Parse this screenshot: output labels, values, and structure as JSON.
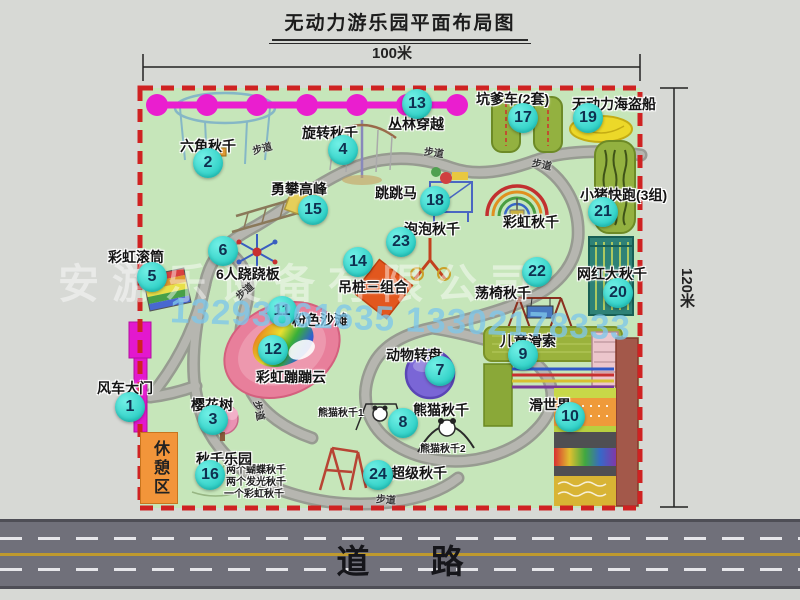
{
  "title": "无动力游乐园平面布局图",
  "dimensions": {
    "width_label": "100米",
    "height_label": "120米"
  },
  "road": {
    "label": "道 路"
  },
  "watermark": {
    "company": "安游乐设备有限公司",
    "phone": "13293861635 13302178333"
  },
  "rest_area_label": "休憩区",
  "trail_label": "步道",
  "rainbow_swing_label": "彩虹秋千",
  "panda_sub1": "熊猫秋千1",
  "panda_sub2": "熊猫秋千2",
  "swing_park_notes": [
    "两个蝴蝶秋千",
    "两个发光秋千",
    "一个彩虹秋千"
  ],
  "markers": [
    {
      "num": "1",
      "label": "风车大门"
    },
    {
      "num": "2",
      "label": "六角秋千"
    },
    {
      "num": "3",
      "label": "樱花树"
    },
    {
      "num": "4",
      "label": "旋转秋千"
    },
    {
      "num": "5",
      "label": "彩虹滚筒"
    },
    {
      "num": "6",
      "label": "6人跷跷板"
    },
    {
      "num": "7",
      "label": "动物转盘"
    },
    {
      "num": "8",
      "label": "熊猫秋千"
    },
    {
      "num": "9",
      "label": "儿童滑索"
    },
    {
      "num": "10",
      "label": "滑世界"
    },
    {
      "num": "11",
      "label": "粉色沙滩"
    },
    {
      "num": "12",
      "label": "彩虹蹦蹦云"
    },
    {
      "num": "13",
      "label": "丛林穿越"
    },
    {
      "num": "14",
      "label": "吊桩三组合"
    },
    {
      "num": "15",
      "label": "勇攀高峰"
    },
    {
      "num": "16",
      "label": "秋千乐园"
    },
    {
      "num": "17",
      "label": "坑爹车(2套)"
    },
    {
      "num": "18",
      "label": "跳跳马"
    },
    {
      "num": "19",
      "label": "无动力海盗船"
    },
    {
      "num": "20",
      "label": "网红大秋千"
    },
    {
      "num": "21",
      "label": "小猪快跑(3组)"
    },
    {
      "num": "22",
      "label": "荡椅秋千"
    },
    {
      "num": "23",
      "label": "泡泡秋千"
    },
    {
      "num": "24",
      "label": "超级秋千"
    }
  ],
  "colors": {
    "marker_bg": "#3bdcd2",
    "border_dash": "#cf2222",
    "chain_magenta": "#e81ecb",
    "park_green": "#c6e6ba",
    "road_gray": "#70707a",
    "rest_area_orange": "#f2953a"
  }
}
